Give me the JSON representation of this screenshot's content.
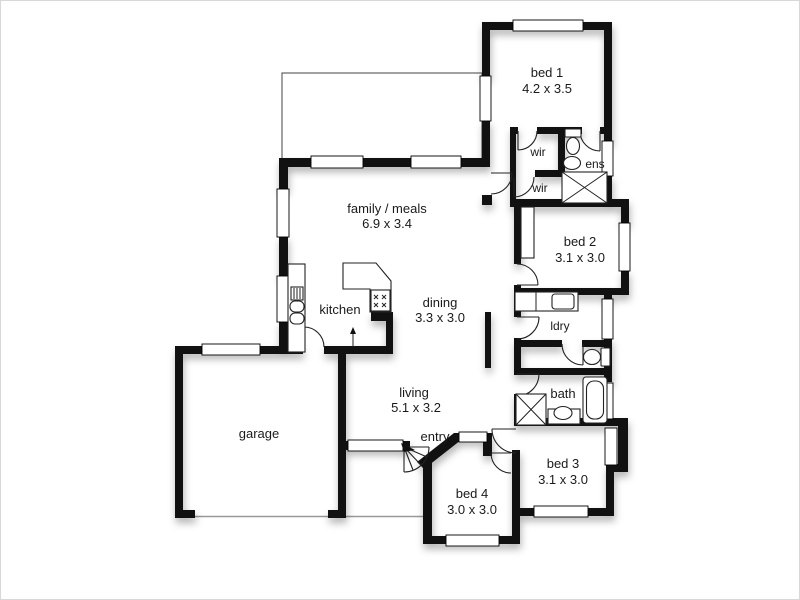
{
  "plan_title": "floor-plan",
  "colors": {
    "wall": "#111111",
    "background": "#ffffff",
    "text": "#1a1a1a",
    "thin_line": "#555555",
    "garage_door_line": "#999999"
  },
  "rooms": {
    "bed1": {
      "label": "bed 1",
      "dims": "4.2 x 3.5"
    },
    "bed2": {
      "label": "bed 2",
      "dims": "3.1 x 3.0"
    },
    "bed3": {
      "label": "bed 3",
      "dims": "3.1 x 3.0"
    },
    "bed4": {
      "label": "bed 4",
      "dims": "3.0 x 3.0"
    },
    "family": {
      "label": "family / meals",
      "dims": "6.9 x 3.4"
    },
    "dining": {
      "label": "dining",
      "dims": "3.3 x 3.0"
    },
    "living": {
      "label": "living",
      "dims": "5.1 x 3.2"
    },
    "kitchen": {
      "label": "kitchen"
    },
    "garage": {
      "label": "garage"
    },
    "entry": {
      "label": "entry"
    },
    "bath": {
      "label": "bath"
    },
    "ldry": {
      "label": "ldry"
    },
    "wir1": {
      "label": "wir"
    },
    "wir2": {
      "label": "wir"
    },
    "ens": {
      "label": "ens"
    }
  }
}
